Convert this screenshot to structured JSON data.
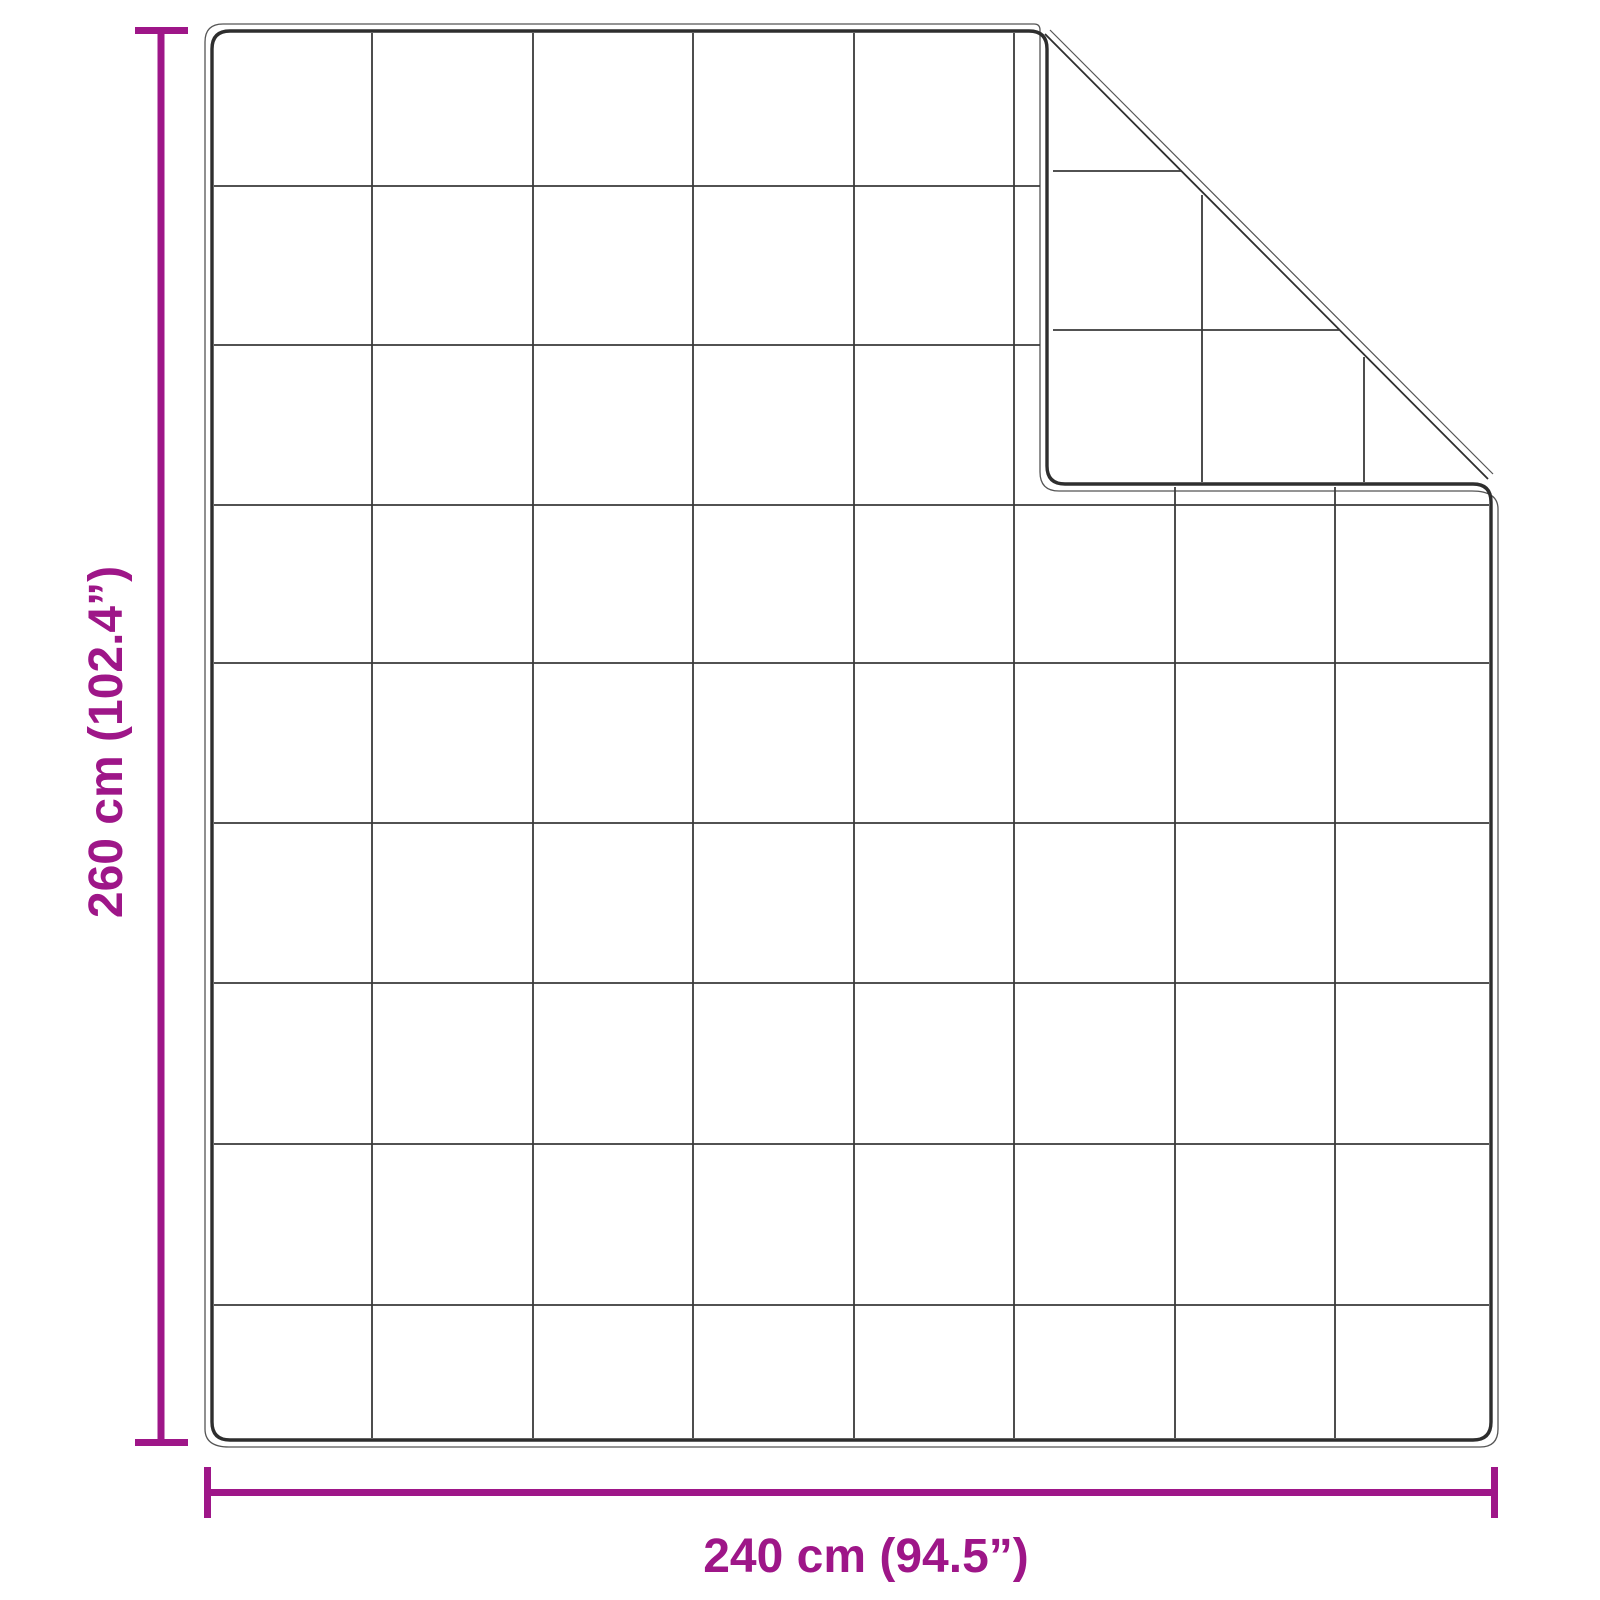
{
  "diagram": {
    "type": "product-dimension-diagram",
    "subject": "quilted blanket with folded top-right corner",
    "vertical_dimension": {
      "label": "260 cm (102.4”)",
      "value_cm": 260,
      "value_inches": 102.4
    },
    "horizontal_dimension": {
      "label": "240 cm (94.5”)",
      "value_cm": 240,
      "value_inches": 94.5
    },
    "quilt_grid": {
      "columns": 8,
      "rows": 9
    },
    "colors": {
      "dimension": "#9e1688",
      "outline": "#2e2e2e",
      "grid": "#3a3a3a",
      "contour": "#555555",
      "background": "#ffffff"
    }
  }
}
